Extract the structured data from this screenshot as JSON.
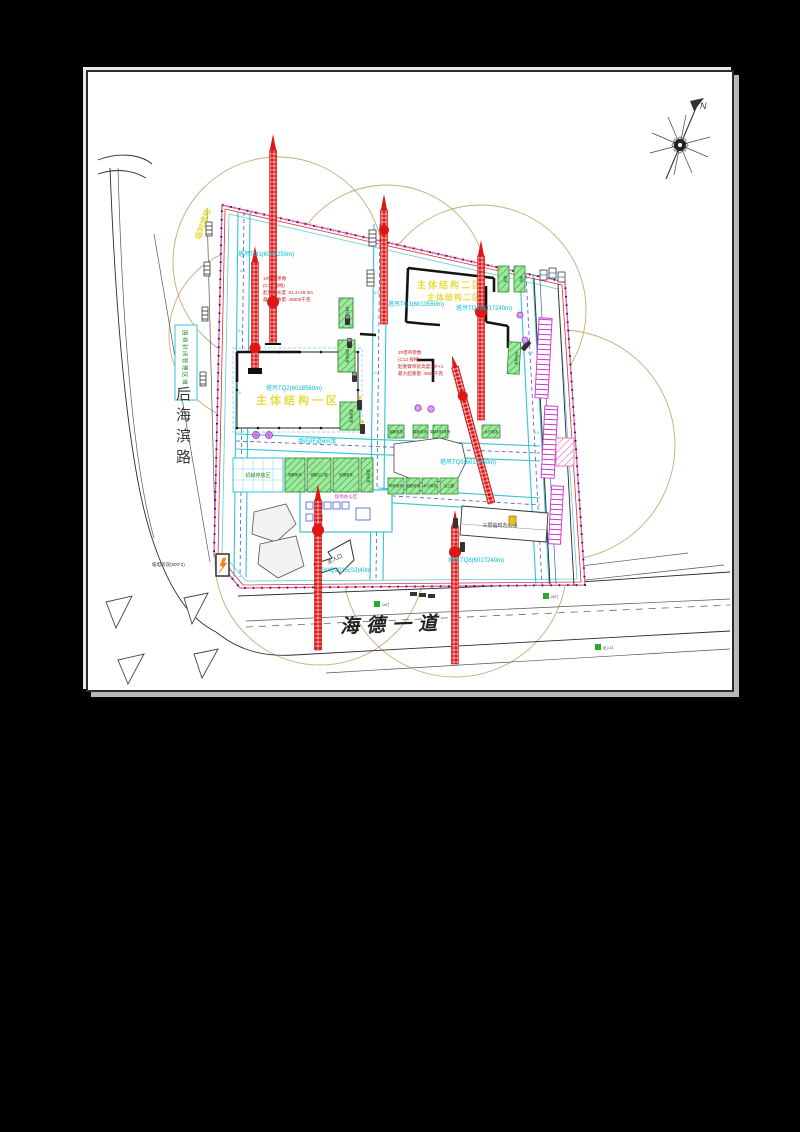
{
  "frame": {
    "page_bg": "#000000",
    "paper_bg": "#ffffff"
  },
  "drawing": {
    "north_label": "N",
    "road_mark": "6.0",
    "roads": {
      "left": "后海滨路",
      "bottom": "海德一道"
    },
    "notes": {
      "power": "临电房双(800*2)",
      "enclosure": "围挡封闭管理区域",
      "store": "临时堆场",
      "gate_main": "主入口",
      "gate1": "1#门",
      "gate2": "2#门",
      "gate3": "出入口"
    },
    "crane_labels": [
      "塔吊TQ1(6017250m)",
      "塔吊TQ2(6018560m)",
      "塔吊TQ3(6013560m)",
      "塔吊TQ4(6017240m)",
      "塔吊TQ5(6017260m)",
      "SMQ2015(S2)40m",
      "塔吊TQ6(6017240m)",
      "场内环道6m宽"
    ],
    "spec1": [
      "1#塔吊参数",
      "(C12 规格)",
      "起重臂长度: 61.3+28.3m",
      "最大起重量: 45500千克"
    ],
    "spec2": [
      "2#塔吊参数",
      "(C13 规格)",
      "起重臂吊装高度: 4F+1",
      "最大起重量: 4500千克"
    ],
    "buildings": {
      "b1": "主体结构二区",
      "b2": "主体结构一区",
      "office": "现场办公区",
      "b4": "三层临时办公楼"
    },
    "materials": {
      "grid_label": "机械停放区",
      "row1": [
        "钢筋堆场",
        "钢筋加工棚",
        "型钢堆场",
        "模板堆场"
      ],
      "column": [
        "材料堆场",
        "周转堆场",
        "模板堆场"
      ],
      "row2": [
        "钢筋堆场",
        "模板堆场",
        "周转材料堆场",
        "木方堆场"
      ],
      "row3": [
        "砌块堆场",
        "钢筋堆场",
        "木方堆场",
        "加工棚"
      ],
      "pair": [
        "堆场",
        "堆场"
      ],
      "strip": "材料堆场"
    },
    "colors": {
      "crane_red": "#e01515",
      "radius_ring": "#b49a52",
      "label_cyan": "#00bfcf",
      "boundary_pink": "#e055b5",
      "boundary_red": "#e03030",
      "green_area": "#8ce08c",
      "magenta": "#cc33cc",
      "road_cyan": "#35c3d5",
      "dash_blue": "#3b62c8"
    }
  }
}
